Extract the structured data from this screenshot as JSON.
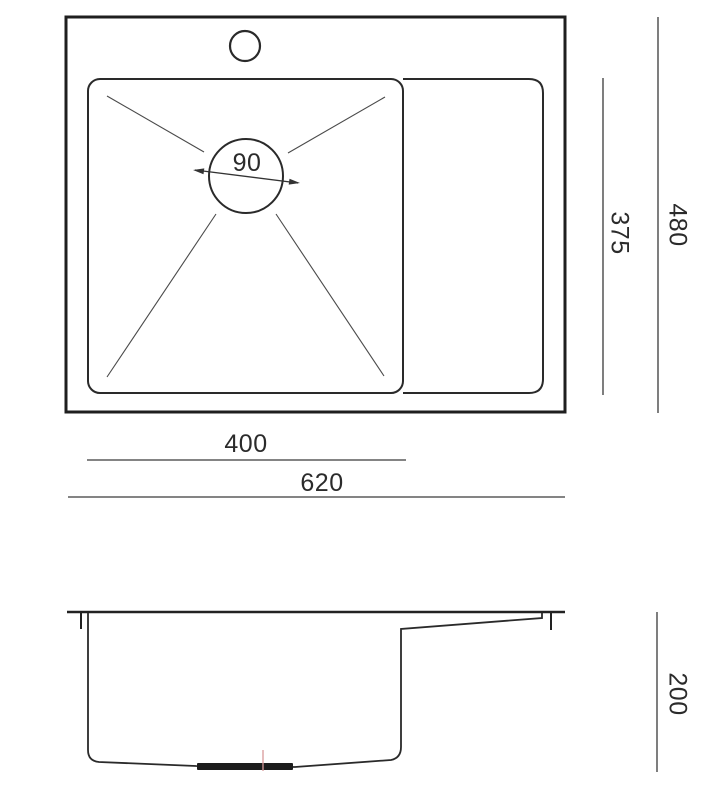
{
  "page": {
    "background": "#ffffff",
    "line_color": "#222222",
    "accent_color": "#d99a9a"
  },
  "drawing": {
    "subject": "kitchen-sink-technical-drawing",
    "views": {
      "top_view_name": "plan view with bowl, drainboard, faucet hole and drain",
      "side_view_name": "side section profile"
    },
    "top_view": {
      "drain_diameter_label": "90",
      "bowl_width_label": "400",
      "overall_width_label": "620",
      "bowl_depth_label": "375",
      "overall_depth_label": "480"
    },
    "side_view": {
      "height_label": "200"
    }
  }
}
